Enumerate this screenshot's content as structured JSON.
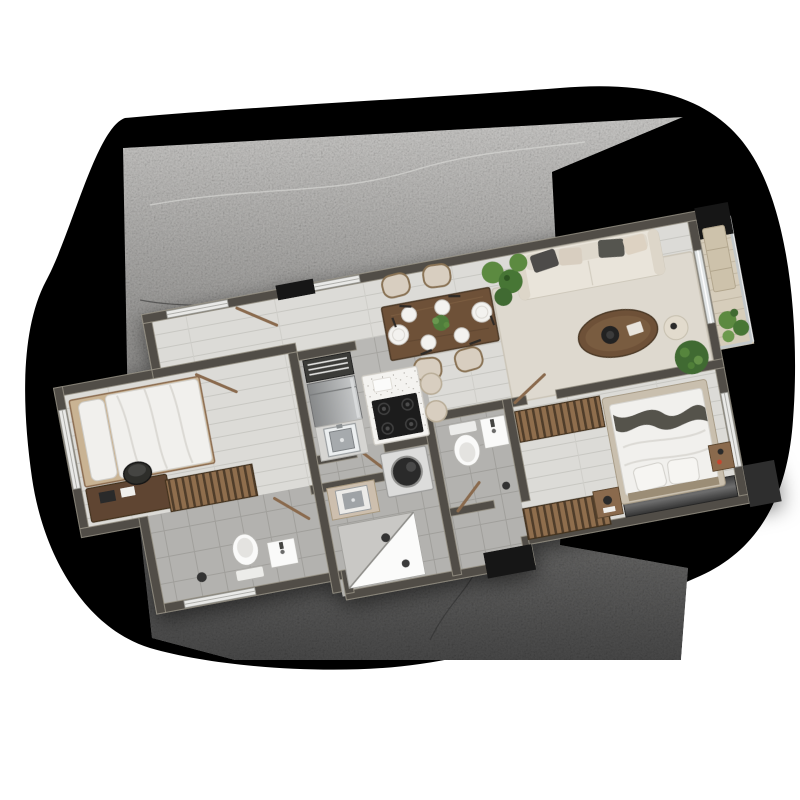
{
  "page": {
    "background": "#ffffff"
  },
  "backdrop": {
    "shadow_blob_color": "#000000",
    "concrete_top": "#c6c5c3",
    "concrete_mid": "#8e8d8b",
    "concrete_bottom": "#474747",
    "crack_light": "#d8d8d6",
    "crack_dark": "#2e2e2e"
  },
  "palette": {
    "wall": "#514e46",
    "wall_edge": "#989386",
    "plank": "#dcdbd7",
    "plank_line": "#c8c7c2",
    "tile": "#b9b8b5",
    "tile_line": "#a6a5a1",
    "bath_tile": "#b3b2af",
    "bath_tile_line": "#a09f9b",
    "rug": "#ded9cf",
    "balcony_deck": "#d6cdbb",
    "wood": "#6e5138",
    "wood_dark": "#4e3a28",
    "slat": "#8f6e4e",
    "slat_dark": "#503d2b",
    "sofa": "#e9e4da",
    "cushion_dark": "#4d4c48",
    "cushion_beige": "#d8cec0",
    "bed_linen": "#f1f0ed",
    "throw": "#55524c",
    "marble": "#f4f3f0",
    "appliance": "#b9babc",
    "counter": "#d6d5d2",
    "cooktop": "#1d1d1d",
    "fixture_white": "#fafaf9",
    "column": "#161616",
    "wardrobe": "#4a4a4a",
    "plant": "#5c8a41",
    "plant_dark": "#3f6b31",
    "glass": "#dfe3e4"
  },
  "floor_plan": {
    "rotation_deg": -10.6,
    "rooms": [
      {
        "name": "entry-hall",
        "floor": "wood-plank",
        "furniture": [
          "entry-door",
          "window"
        ]
      },
      {
        "name": "dining-area",
        "floor": "wood-plank",
        "furniture": [
          "dining-table",
          "dining-chair x4",
          "plate x6",
          "centerpiece-plant",
          "cutlery"
        ]
      },
      {
        "name": "living-room",
        "floor": "wood-plank",
        "furniture": [
          "sofa",
          "throw-pillows",
          "area-rug",
          "oval-coffee-table",
          "side-pouf",
          "round-bush-plant",
          "monstera-plant"
        ]
      },
      {
        "name": "balcony",
        "floor": "deck",
        "furniture": [
          "bench",
          "potted-plants",
          "glass-railing",
          "sliding-door"
        ]
      },
      {
        "name": "kitchen",
        "floor": "tile",
        "furniture": [
          "louver-cabinet",
          "refrigerator",
          "counter-with-sink",
          "marble-island",
          "gas-cooktop",
          "bar-stool x2"
        ]
      },
      {
        "name": "utility-bath",
        "floor": "tile",
        "furniture": [
          "washing-machine",
          "small-counter-sink",
          "corner-shower",
          "floor-drain"
        ]
      },
      {
        "name": "center-wc",
        "floor": "tile",
        "furniture": [
          "toilet",
          "washbasin",
          "door"
        ]
      },
      {
        "name": "bedroom-left",
        "floor": "wood-plank",
        "furniture": [
          "single-bed",
          "desk",
          "office-chair",
          "slatted-wardrobe",
          "window"
        ]
      },
      {
        "name": "wc-left",
        "floor": "tile",
        "furniture": [
          "toilet",
          "small-sink",
          "floor-drain",
          "window"
        ]
      },
      {
        "name": "dressing-corridor",
        "floor": "wood-plank",
        "furniture": [
          "slatted-closet x2"
        ]
      },
      {
        "name": "master-bedroom",
        "floor": "wood-plank",
        "furniture": [
          "double-bed",
          "pillows",
          "dark-throw",
          "nightstand",
          "side-table",
          "built-in-wardrobe",
          "window"
        ]
      }
    ],
    "structure": [
      "concrete-columns x4",
      "exterior-windows",
      "interior-doors"
    ]
  }
}
